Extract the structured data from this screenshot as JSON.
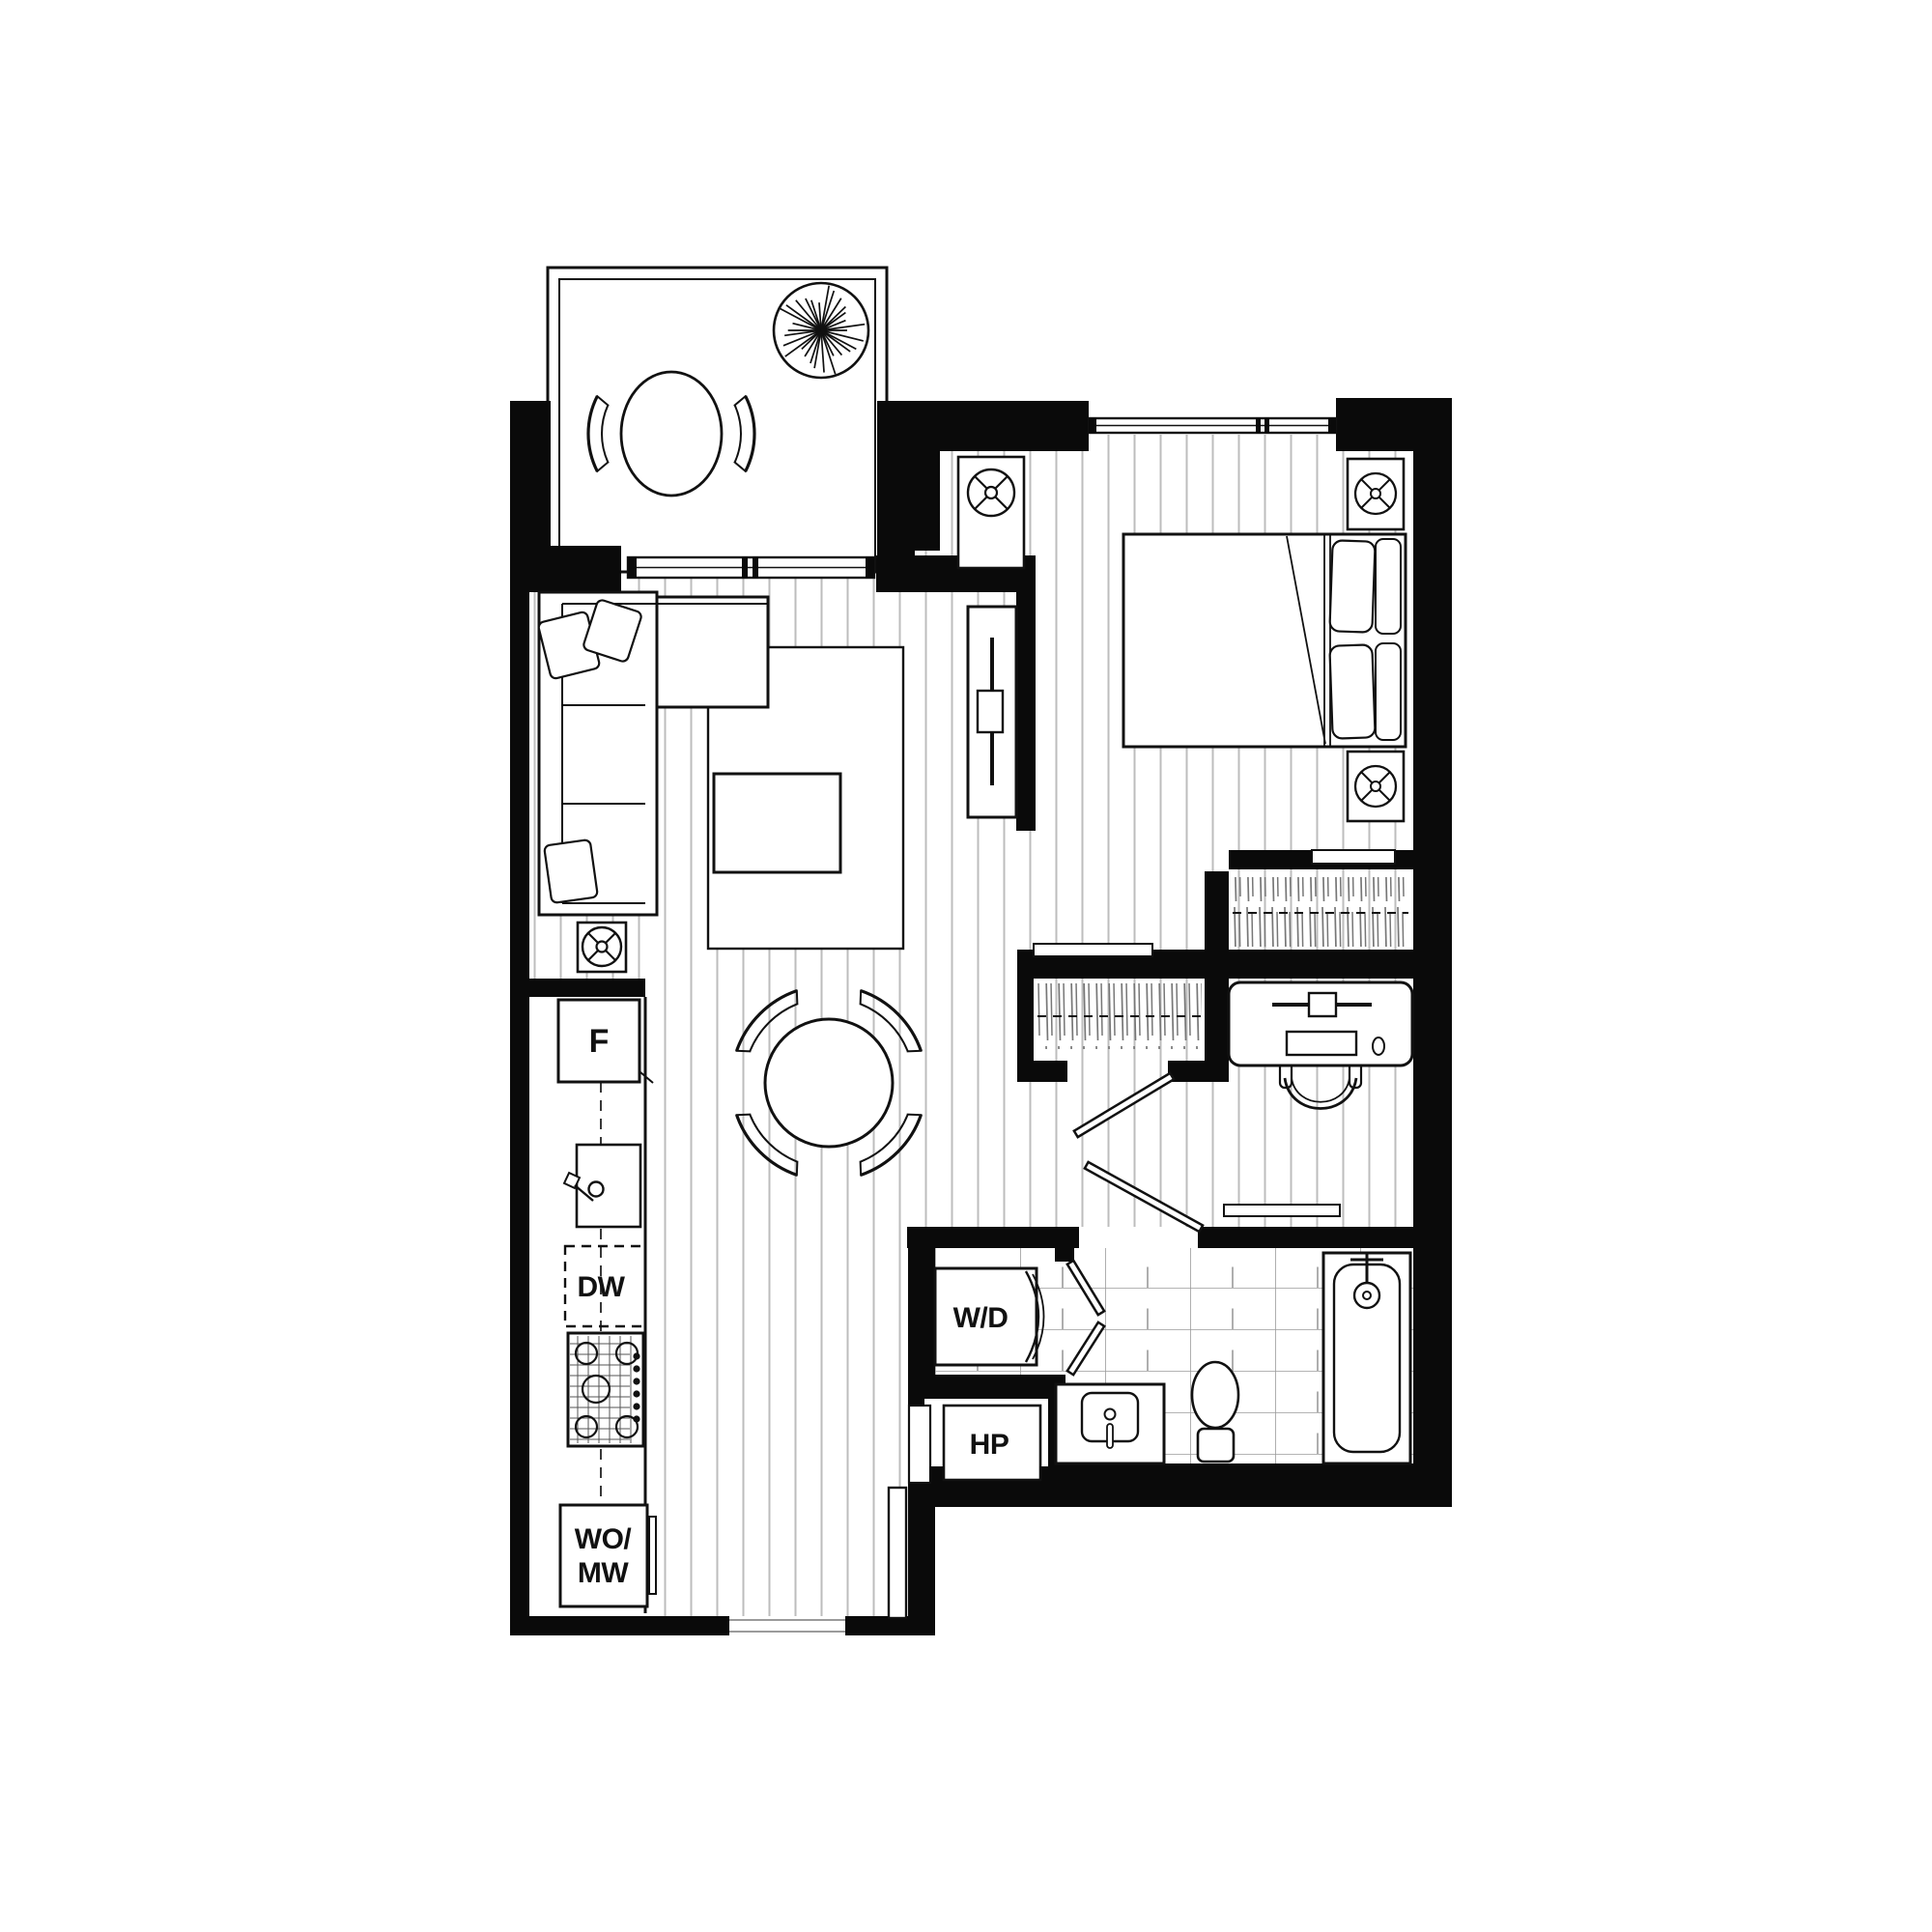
{
  "document": {
    "type": "apartment-floor-plan",
    "page_background": "#ffffff"
  },
  "labels": {
    "fridge": "F",
    "dishwasher": "DW",
    "wall_oven": "WO/",
    "microwave": "MW",
    "washer_dryer": "W/D",
    "heat_pump": "HP"
  },
  "colors": {
    "wall": "#0a0a0a",
    "stroke": "#111111",
    "plank_line": "#bdbdbd",
    "tile_line": "#9b9b9b",
    "hanger_line": "#777777",
    "background": "#ffffff"
  }
}
